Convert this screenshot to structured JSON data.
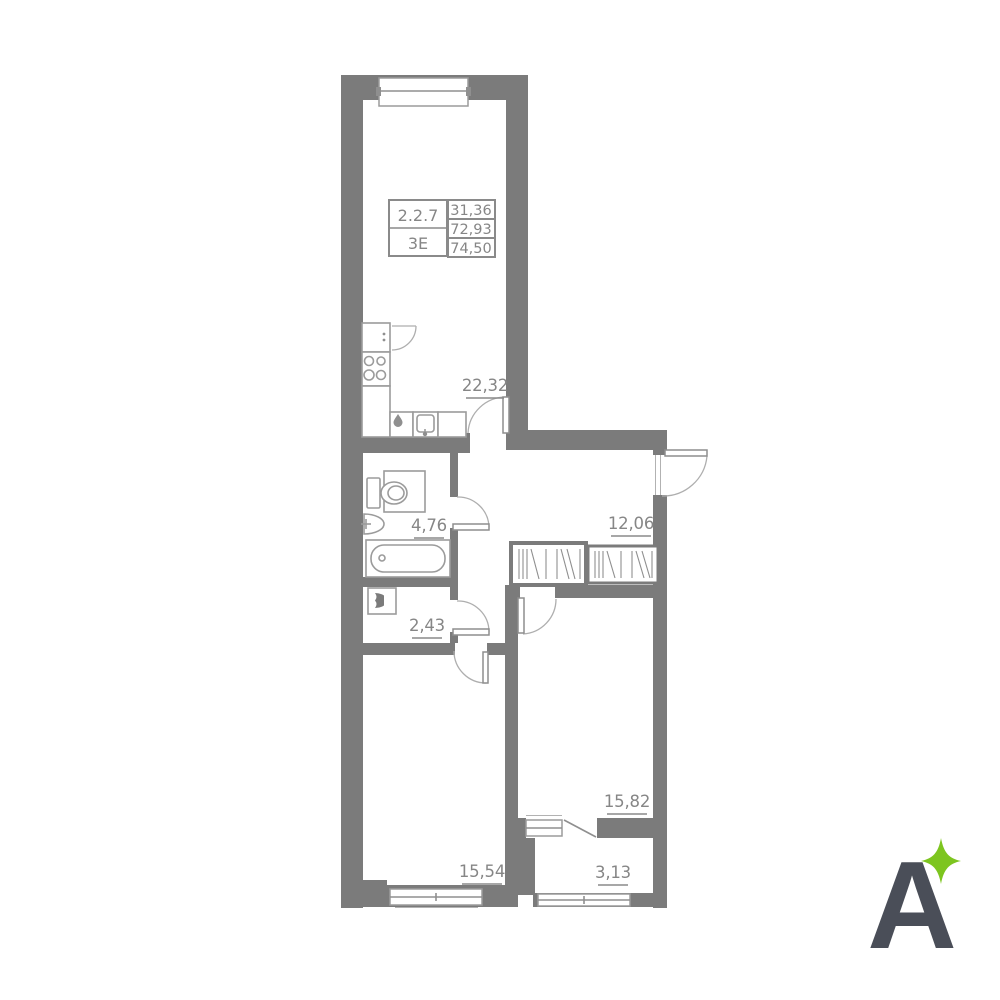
{
  "floorplan": {
    "unit_card": {
      "number": "2.2.7",
      "type": "3E",
      "areas": [
        "31,36",
        "72,93",
        "74,50"
      ]
    },
    "rooms": {
      "kitchen_living": "22,32",
      "hallway": "12,06",
      "bathroom": "4,76",
      "laundry": "2,43",
      "bedroom_right": "15,82",
      "bedroom_left": "15,54",
      "balcony": "3,13"
    },
    "colors": {
      "wall": "#7b7b7b",
      "fixture_line": "#9b9b9b",
      "label_text": "#868686",
      "logo_letter": "#4a4e58",
      "logo_star": "#7dc51f"
    }
  },
  "logo": {
    "letter": "A"
  }
}
